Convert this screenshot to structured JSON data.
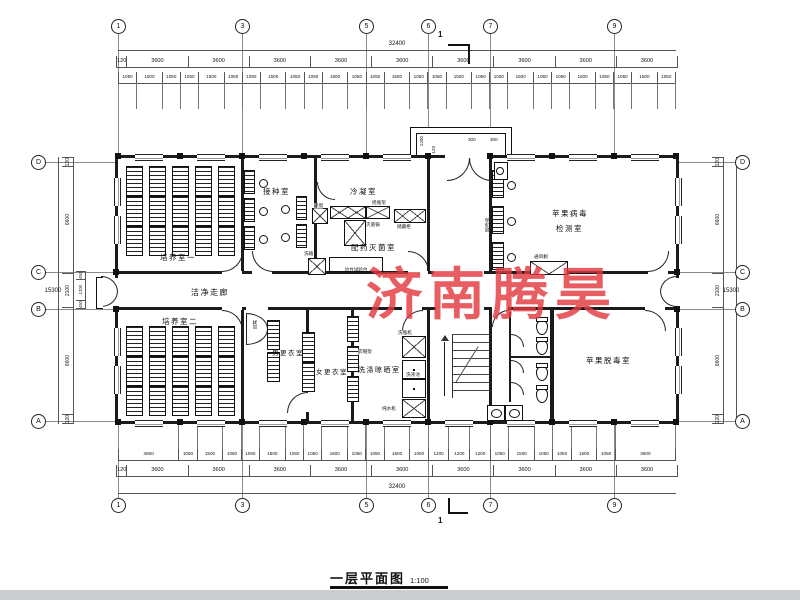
{
  "meta": {
    "title": "一层平面图",
    "scale": "1:100",
    "watermark": "济南腾昊"
  },
  "colors": {
    "watermark": "#e23a3f"
  },
  "grid": {
    "col_labels": [
      "1",
      "3",
      "5",
      "6",
      "7",
      "9"
    ],
    "row_labels": [
      "D",
      "C",
      "B",
      "A"
    ],
    "section_label": "1"
  },
  "dims": {
    "top": {
      "overall": "32400",
      "bays": [
        120,
        3600,
        3600,
        3600,
        3600,
        3600,
        3600,
        3600,
        3600,
        3600
      ],
      "sub": [
        1050,
        1500,
        1050,
        1050,
        1500,
        1050,
        1050,
        1500,
        1050,
        1050,
        1500,
        1050,
        1050,
        1500,
        1050,
        1050,
        1500,
        1050,
        1050,
        1500,
        1050,
        1050,
        1500,
        1050,
        1050,
        1500,
        1050
      ]
    },
    "bottom": {
      "overall": "32400",
      "bays": [
        120,
        3600,
        3600,
        3600,
        3600,
        3600,
        3600,
        3600,
        3600,
        3600
      ],
      "sub": [
        3600,
        1050,
        1500,
        1050,
        1050,
        1500,
        1050,
        1050,
        1500,
        1050,
        1050,
        1500,
        1050,
        1200,
        1200,
        1200,
        1050,
        1500,
        1050,
        1050,
        1500,
        1050,
        3600
      ]
    },
    "left": {
      "overall": "15300",
      "segs": [
        120,
        6600,
        2100,
        6600,
        120
      ],
      "sub": [
        450,
        1200,
        450
      ]
    },
    "right": {
      "overall": "15300",
      "segs": [
        120,
        6600,
        2100,
        6600,
        120
      ]
    },
    "entrance": {
      "depth": "1200",
      "win_a": "300",
      "win_b": "300",
      "wall": "120"
    }
  },
  "rooms": {
    "culture1": "培养室一",
    "inoculation": "接种室",
    "condensing": "冷凝室",
    "prep": "配药灭菌室",
    "corridor": "洁净走廊",
    "virus1": "苹果病毒",
    "virus2": "检测室",
    "culture2": "培养室二",
    "men": "男更衣室",
    "women": "女更衣室",
    "washing": "洗涤晾晒室",
    "detox": "苹果脱毒室"
  },
  "equipment": {
    "pass_window": "递窗",
    "wash_box": "洗箱",
    "shaker_rack": "摇瓶架",
    "sterilizer": "灭菌锅",
    "storage": "储藏柜",
    "side_bench": "边台试验台",
    "clean_bench": "超净台",
    "fume_hood": "通风橱",
    "air_shower": "风淋",
    "bottle_washer": "洗瓶机",
    "sink_label": "洗涤池",
    "water_machine": "纯水机",
    "coat_rack": "衣帽架"
  }
}
